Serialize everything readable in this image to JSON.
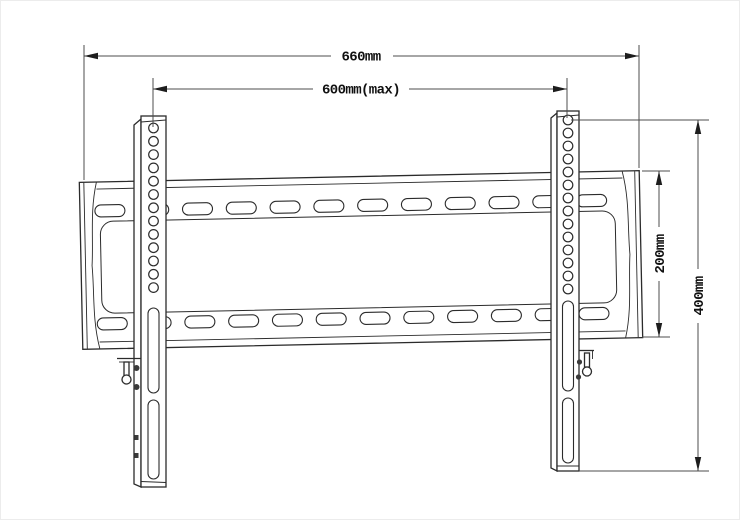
{
  "drawing": {
    "subject": "TV wall mount bracket technical line drawing, front view",
    "colors": {
      "line": "#2b2b2b",
      "dimension": "#4c4c4c",
      "background": "#ffffff"
    }
  },
  "dimensions": {
    "overall_width": {
      "label": "660mm",
      "orientation": "horizontal"
    },
    "hole_span": {
      "label": "600mm(max)",
      "orientation": "horizontal"
    },
    "plate_height": {
      "label": "200mm",
      "orientation": "vertical"
    },
    "rail_height": {
      "label": "400mm",
      "orientation": "vertical"
    }
  },
  "bracket": {
    "plate_slot_columns": 12,
    "left_rail_hole_count": 13,
    "right_rail_hole_count": 14
  }
}
